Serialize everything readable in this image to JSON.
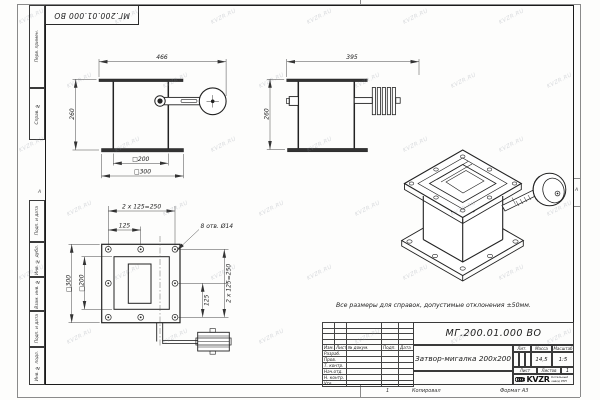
{
  "sheet": {
    "watermark": "KVZR.RU",
    "stamp_top": "МГ.200.01.000 ВО",
    "margin_labels": {
      "perv_primen": "Перв. примен.",
      "sprav_no": "Справ. №",
      "podp_data_1": "Подп. и дата",
      "inv_dubl": "Инв. № дубл.",
      "vzam_inv": "Взам. инв. №",
      "podp_data_2": "Подп. и дата",
      "inv_podl": "Инв. № подл.",
      "zone_left": "А",
      "zone_right": "А"
    },
    "bottom": {
      "zone_number": "1",
      "copied": "Копировал",
      "format": "Формат А3"
    }
  },
  "note": "Все размеры для справок, допустимые отклонения ±50мм.",
  "views": {
    "front": {
      "dim_width": "466",
      "dim_height": "260",
      "dim_inner": "□200",
      "dim_outer": "□300"
    },
    "side": {
      "dim_width": "395",
      "dim_height": "260"
    },
    "flange": {
      "dim_pitch_total_top": "2 x 125=250",
      "dim_pitch_top": "125",
      "holes_label": "8 отв. Ø14",
      "dim_outer": "□300",
      "dim_inner": "□200",
      "dim_pitch_total_right": "2 x 125=250",
      "dim_pitch_right": "125"
    }
  },
  "title_block": {
    "doc_number": "МГ.200.01.000 ВО",
    "name": "Затвор-мигалка 200х200",
    "columns": [
      "Изм.",
      "Лист",
      "№ докум.",
      "Подп.",
      "Дата"
    ],
    "sig_rows": [
      "Разраб.",
      "Пров.",
      "Т. контр.",
      "Нач.отд.",
      "Н. контр.",
      "Утв."
    ],
    "lit_label": "Лит.",
    "mass_label": "Масса",
    "mass_value": "14,5",
    "scale_label": "Масштаб",
    "scale_value": "1:5",
    "sheet_label": "Лист",
    "sheets_label": "Листов",
    "sheets_value": "1",
    "logo_text": "KVZR",
    "company_line1": "Котельный",
    "company_line2": "завод РЭП"
  }
}
